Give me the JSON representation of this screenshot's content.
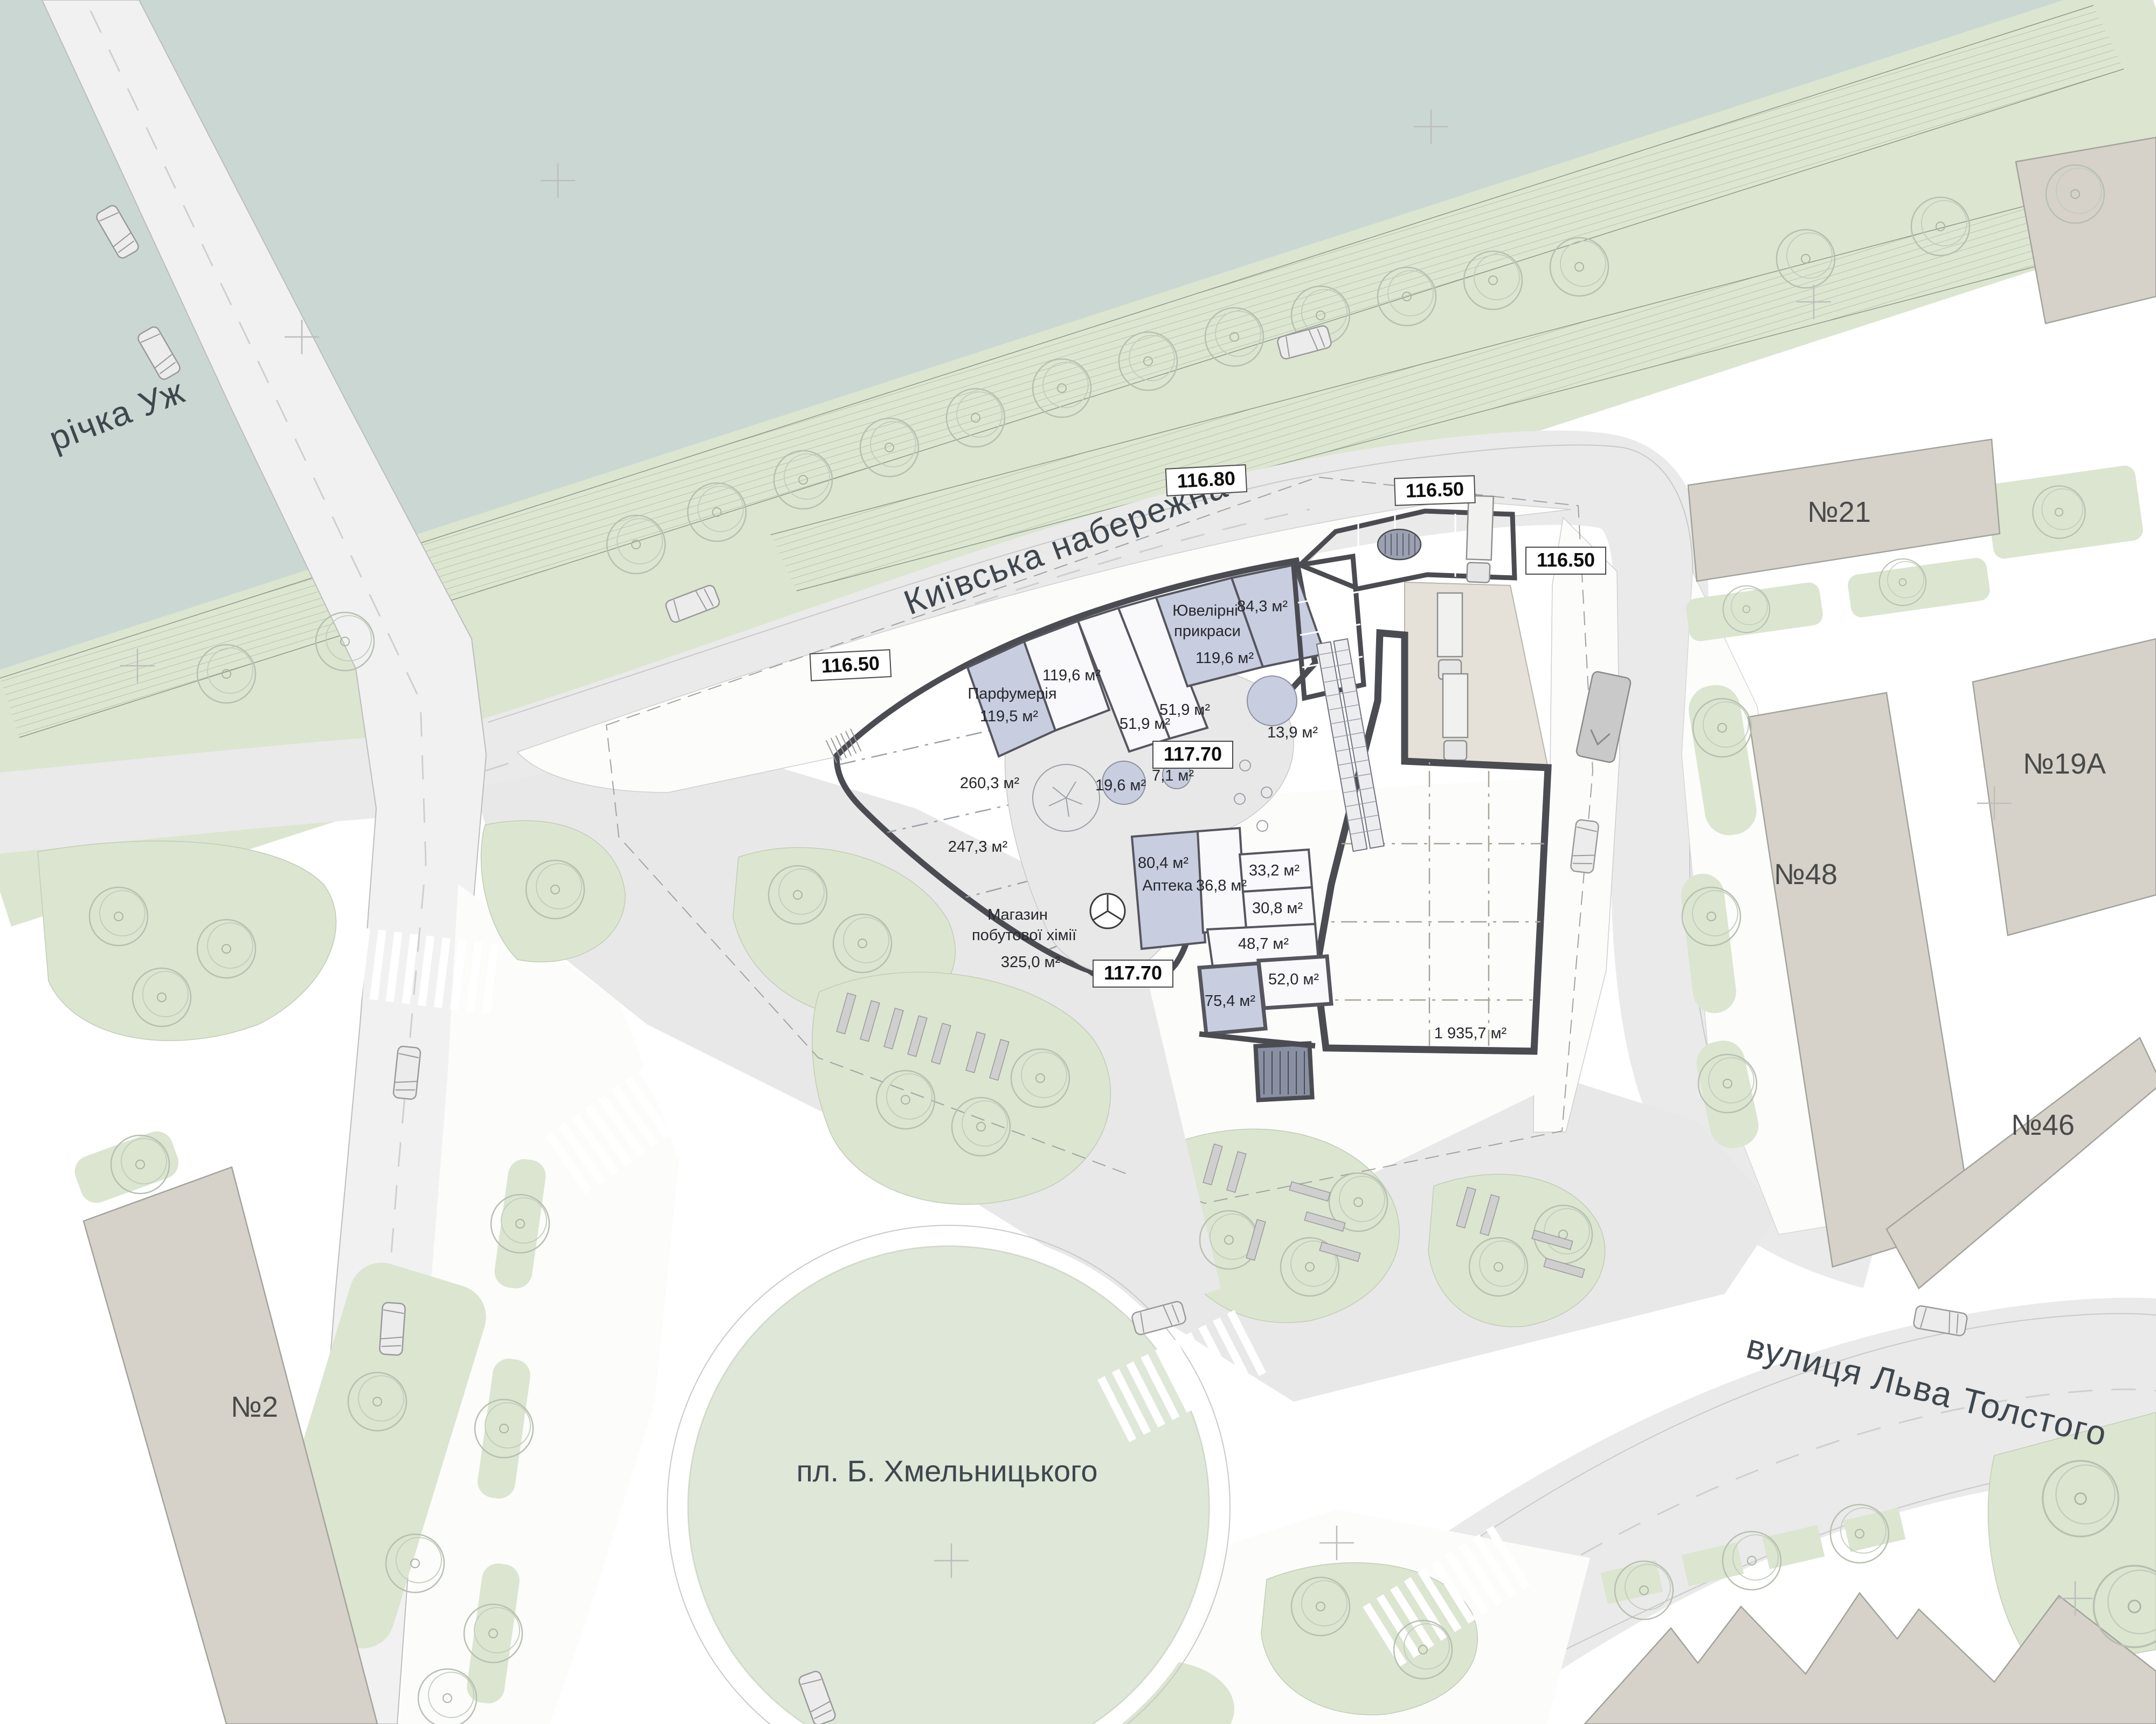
{
  "map": {
    "river_label": "річка Уж",
    "streets": {
      "embankment": "Київська набережна",
      "tolstoy": "вулиця Льва Толстого",
      "square": "пл. Б. Хмельницького"
    },
    "elevations": {
      "e11680": "116.80",
      "e11650": "116.50",
      "e11770": "117.70"
    },
    "buildings": {
      "b21": "№21",
      "b19a": "№19А",
      "b48": "№48",
      "b46": "№46",
      "b2": "№2"
    },
    "units": {
      "perfumery": {
        "name": "Парфумерія",
        "area": "119,5 м²"
      },
      "retail_a": {
        "area": "119,6 м²"
      },
      "small_a": {
        "area": "51,9 м²"
      },
      "small_b": {
        "area": "51,9 м²"
      },
      "jewelry": {
        "name_line1": "Ювелірні",
        "name_line2": "прикраси",
        "area": "119,6 м²"
      },
      "unit_84": {
        "area": "84,3 м²"
      },
      "kiosk_round": {
        "area": "13,9 м²"
      },
      "planter_a": {
        "area": "19,6 м²"
      },
      "planter_b": {
        "area": "7,1 м²"
      },
      "sales_a": {
        "area": "260,3 м²"
      },
      "sales_b": {
        "area": "247,3 м²"
      },
      "household": {
        "name_line1": "Магазин",
        "name_line2": "побутової хімії",
        "area": "325,0 м²"
      },
      "pharmacy": {
        "name": "Аптека",
        "area": "80,4 м²"
      },
      "unit_36": {
        "area": "36,8 м²"
      },
      "unit_33": {
        "area": "33,2 м²"
      },
      "unit_30": {
        "area": "30,8 м²"
      },
      "unit_48": {
        "area": "48,7 м²"
      },
      "unit_52": {
        "area": "52,0 м²"
      },
      "unit_75": {
        "area": "75,4 м²"
      },
      "sales_hall": {
        "area": "1 935,7 м²"
      }
    },
    "colors": {
      "river": "#cbd7d2",
      "bank_hatch": "#dde6d1",
      "lawn": "#dbe5d0",
      "road": "#eaeaea",
      "context_building": "#d6d2c9",
      "sales_area": "#b7bbce",
      "shop": "#c9cde0",
      "service": "#8a90a3",
      "hall": "#ddd8cf",
      "wall": "#4b4c52"
    }
  }
}
